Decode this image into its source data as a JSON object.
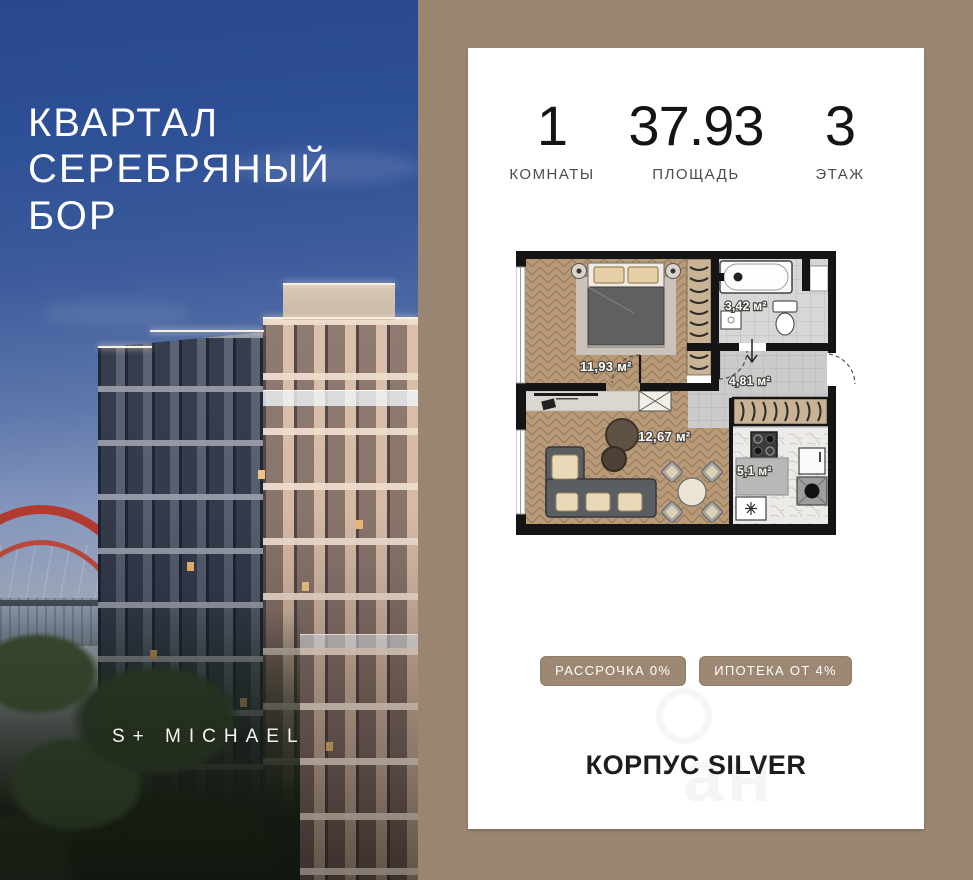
{
  "left_panel": {
    "title_line1": "КВАРТАЛ",
    "title_line2": "СЕРЕБРЯНЫЙ",
    "title_line3": "БОР",
    "brand": "S+ MICHAEL"
  },
  "card": {
    "stats": [
      {
        "value": "1",
        "label": "КОМНАТЫ"
      },
      {
        "value": "37.93",
        "label": "ПЛОЩАДЬ"
      },
      {
        "value": "3",
        "label": "ЭТАЖ"
      }
    ],
    "badges": [
      "РАССРОЧКА 0%",
      "ИПОТЕКА ОТ 4%"
    ],
    "building_title": "КОРПУС SILVER",
    "watermark": "ан"
  },
  "floor_plan": {
    "rooms": [
      {
        "name": "bedroom",
        "area_label": "11,93 м²"
      },
      {
        "name": "bathroom",
        "area_label": "3,42 м²"
      },
      {
        "name": "hallway",
        "area_label": "4,81 м²"
      },
      {
        "name": "living-room",
        "area_label": "12,67 м²"
      },
      {
        "name": "kitchen",
        "area_label": "5,1 м²"
      }
    ]
  },
  "colors": {
    "background_tan": "#9a8570",
    "badge_tan": "#9d8873",
    "wall_black": "#151515",
    "wood_floor": "#b99a78",
    "tile_gray": "#cdcdcd",
    "sky_blue": "#2b4a90",
    "bridge_red": "#b23a31"
  }
}
